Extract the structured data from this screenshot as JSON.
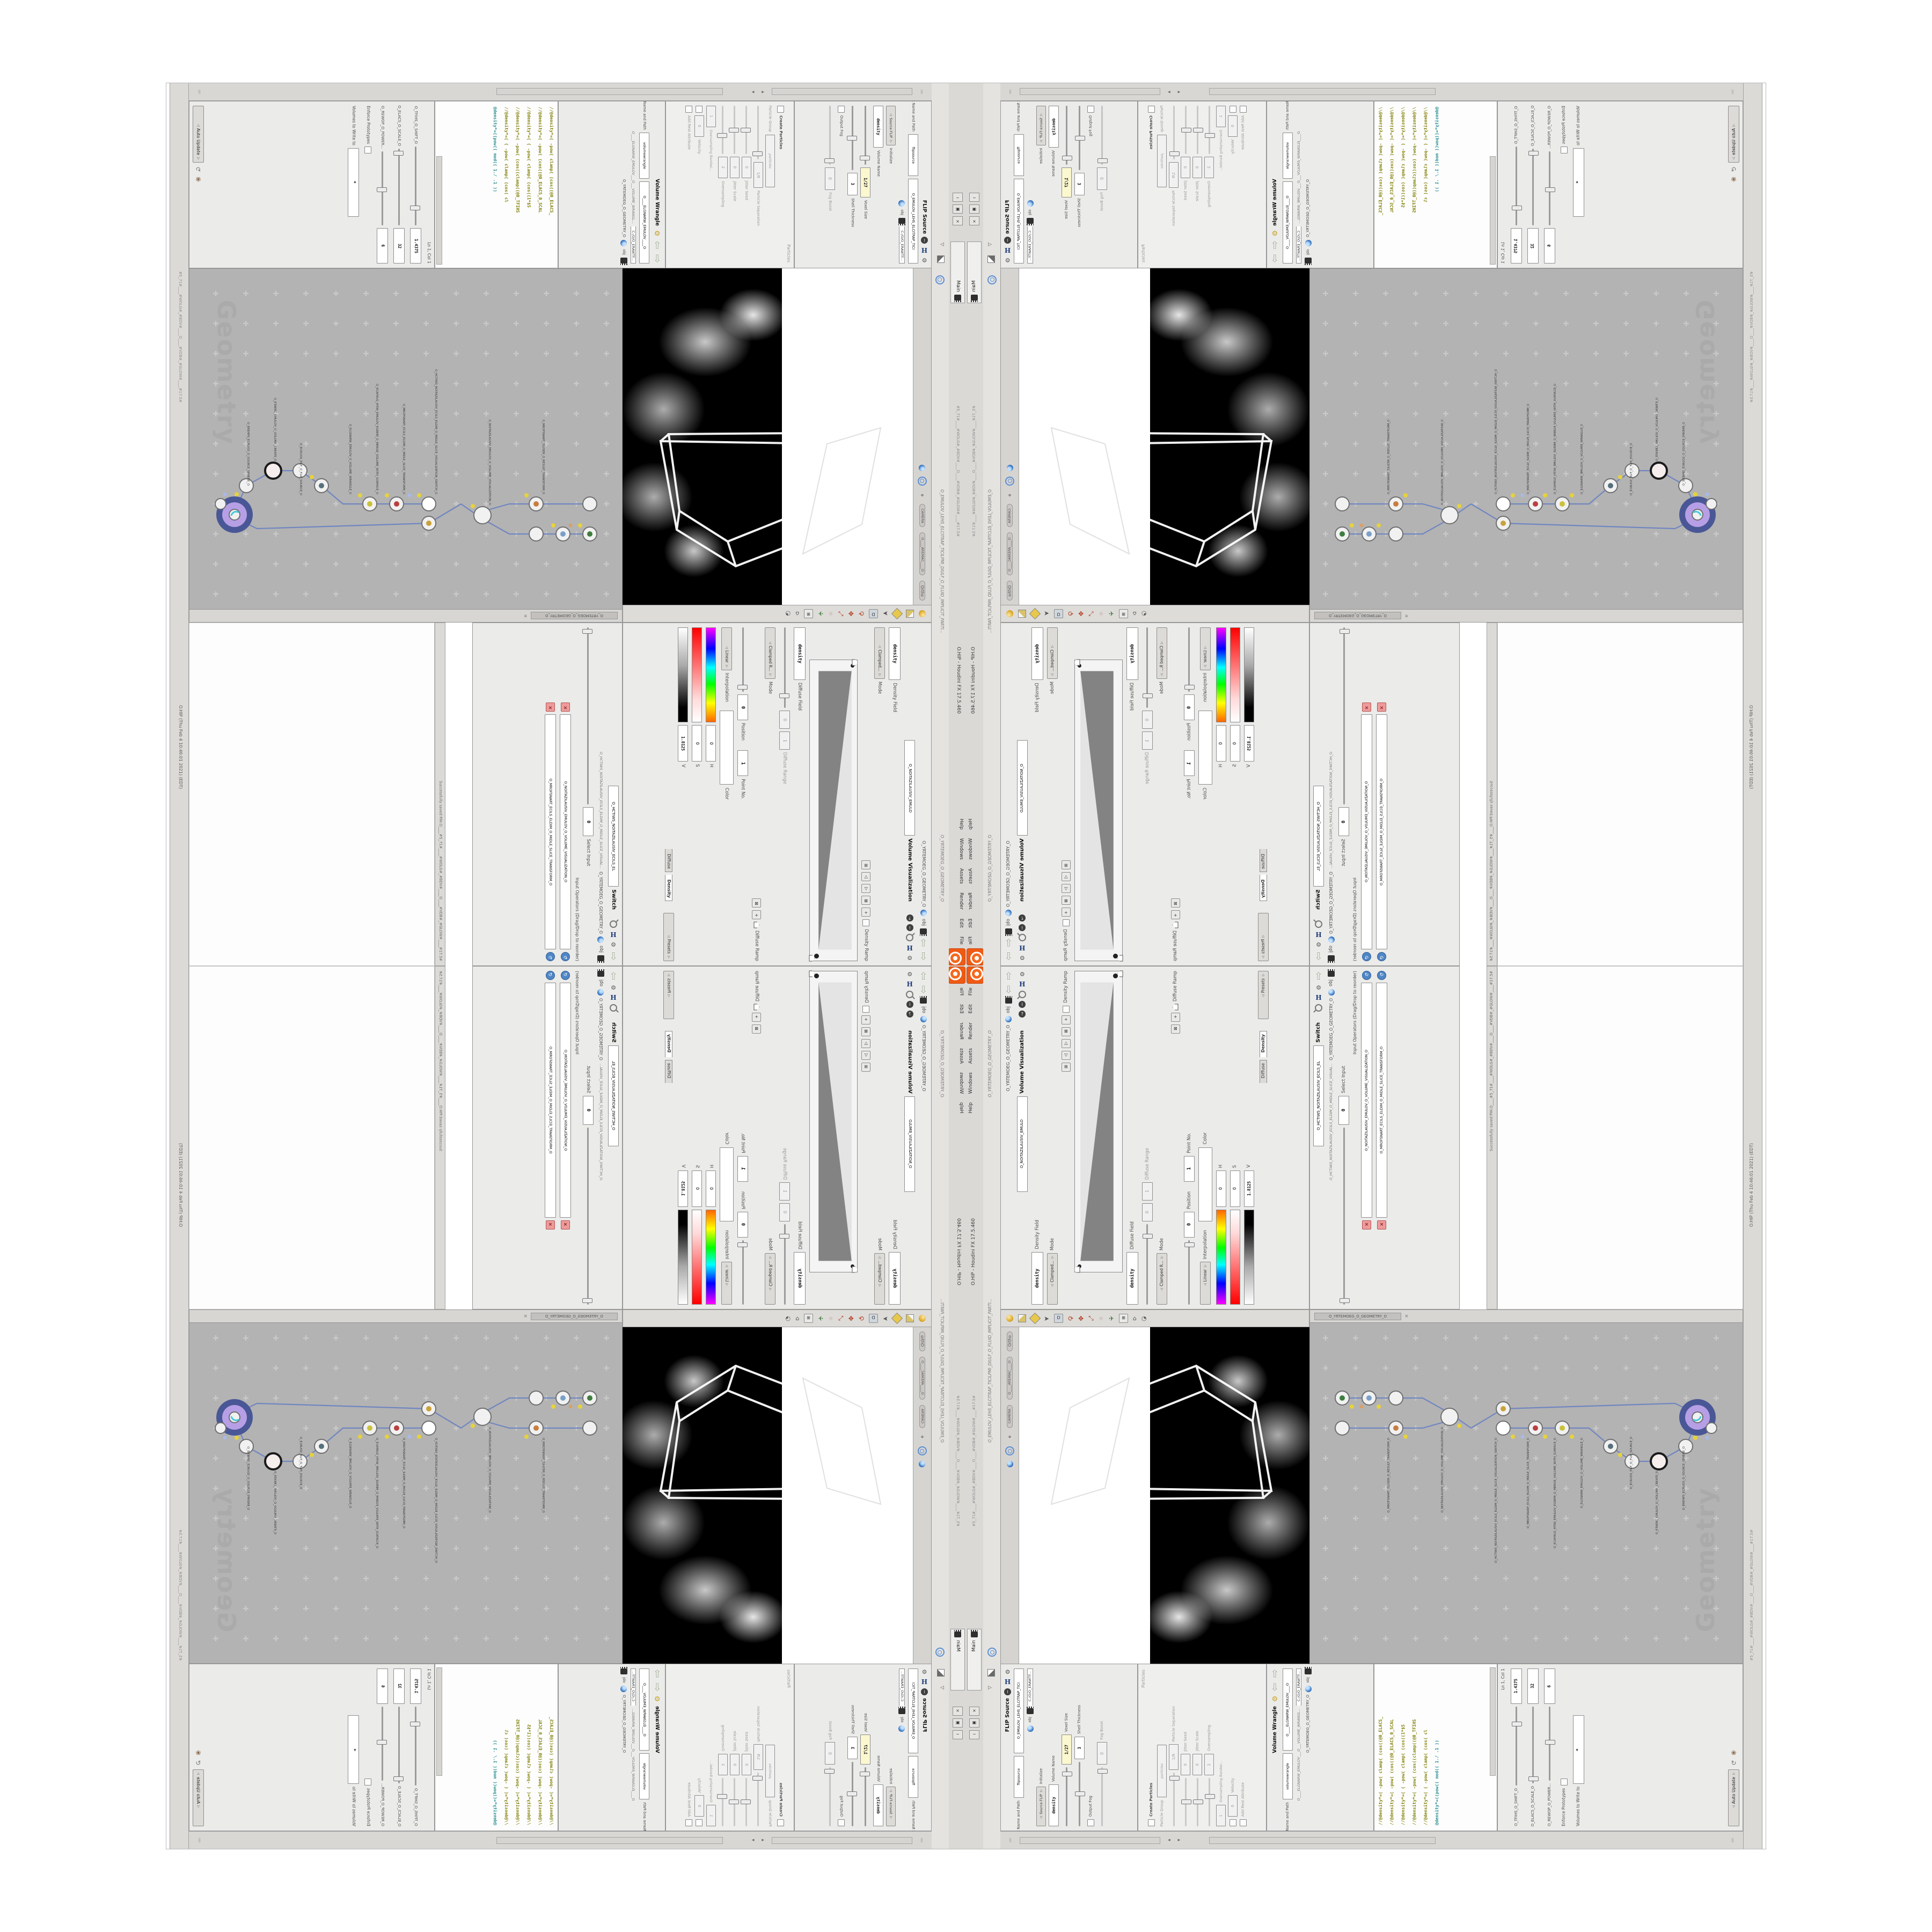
{
  "window": {
    "title": "O.HIP - Houdini FX 17.5.460",
    "meta": "#5_71#____#WOLG#_#BDV#____O____#VDB#_#GLOW#____#17.5#",
    "menu_items": [
      "File",
      "Edit",
      "Render",
      "Assets",
      "Windows",
      "Help"
    ],
    "main_tab": "Main",
    "btn_min": "─",
    "btn_restore": "▣",
    "btn_close": "×"
  },
  "status": {
    "saved": "Successfully saved PIH.O____#5_71#____#WOLG#_#BDV#____O____#VDB#_#GLOW#____#17.5#",
    "datetime": "O.HIP (Thu Feb 4 10:46:01 2021) (EDT)"
  },
  "breadcrumb": {
    "obj": "obj",
    "path": "O_YRTEMOEG_O_GEOMETRY_O"
  },
  "tabs": {
    "geometry": "O_YRTEMOEG_O_GEOMETRY_O",
    "flip_long": "O_EMULOV_LEHS_ELCITRAP_TICILPMI_DIULF_O_FLUID_IMPLICIT_PARTI...",
    "wrangle_long": "O____ELGNARW_EMULOV___O___VOLUME_WRANGL...",
    "visualization_long": "O_HCTIWS_NOITAZILAUSIV_ECILS_ELDIM_O_MIDLE_SLICE_VISUAL...",
    "camera": "O____AREMAC____O",
    "mantra": "O____ARTNAM____O",
    "file": "C:/O/O_ERAWTF..."
  },
  "volviz": {
    "title": "Volume Visualization",
    "tab": "O_NOITAZILAUSIV_EMULO",
    "density_field_label": "Density Field",
    "density_field_value": "density",
    "mode_label": "Mode",
    "mode_value": "Clamped...",
    "mode2_value": "Clamped R...",
    "density_ramp_label": "Density Ramp",
    "diffuse_field_label": "Diffuse Field",
    "diffuse_field_value": "density",
    "diffuse_range_label": "Diffuse Range",
    "range_hi": "1",
    "range_lo": "0",
    "diffuse_ramp_label": "Diffuse Ramp",
    "point_no_label": "Point No.",
    "point_no_value": "1",
    "position_label": "Position",
    "position_value": "0",
    "color_label": "Color",
    "interp_label": "Interpolation",
    "interp_value": "Linear",
    "h_label": "H",
    "h_value": "0",
    "s_label": "S",
    "s_value": "0",
    "v_label": "V",
    "v_value": "1.8125",
    "presets_label": "Presets",
    "tab_density": "Density",
    "tab_diffuse": "Diffuse"
  },
  "switch_pane": {
    "title": "Switch",
    "tab": "O_HCTIWS_NOITAZILAUSIV_ECILS_EL",
    "select_input_label": "Select Input",
    "select_input_value": "0",
    "operators_label": "Input Operators (Drag/Drop to reorder)",
    "op1": "O_NOITAZILAUSIV_EMULOV_O_VOLUME_VISUALIZATION_O",
    "op2": "O_MROFSNART_ECILS_ELDIM_O_MIDLE_SLICE_TRANSFORM_O"
  },
  "flip": {
    "title": "FLIP Source",
    "name_value": "O_EMULOV_LEHS_ELCITRAP_TICI",
    "name2_value": "flipsource",
    "asset_label": "Asset Name and Path",
    "initialize_label": "Initialize",
    "initialize_value": "Source FLIP",
    "volume_name_label": "Volume Name",
    "volume_name_value": "density",
    "voxel_size_label": "Voxel Size",
    "voxel_size_value": "1/27",
    "shell_label": "Shell Thickness",
    "shell_value": "3",
    "output_fog_label": "Output Fog",
    "fog_boost_label": "Fog Boost",
    "fog_boost_value": "0",
    "particles_group": "Particles",
    "create_particles_label": "Create Particles",
    "particles_value": "particles",
    "particle_group_label": "Particle Group",
    "particle_sep_label": "Particle Separation",
    "particle_sep_value": "1/9",
    "jitter_seed_label": "Jitter Seed",
    "jitter_seed_value": "0",
    "jitter_scale_label": "Jitter Scale",
    "jitter_scale_value": "0",
    "oversampling_label": "Oversampling",
    "oversampling_value": "2",
    "oversampling_bw_label": "Oversampling Bandwi...",
    "oversampling_bw_value": "1",
    "velocity_label": "Velocity",
    "velocity_value": "0",
    "add_rest_label": "Add Rest Attribute"
  },
  "wrangle": {
    "title": "Volume Wrangle",
    "name_value": "O____ELGNARW_EMULOV____O",
    "name2_value": "volumewrangle",
    "asset_label": "Asset Name and Path"
  },
  "code": {
    "lines": [
      "//@density*=( -pow( clamp( (cos((@0_ELACS_",
      "//@density*=( -pow( (cos((@0_ELACS_0_SCAL",
      "//@density*=( ( -pow( clamp( (cos((1*$S",
      "//@density*=( -pow( (cos((clamp((@0_TFIHS",
      "//@density*=( ( -pow( clamp( (cos( cl",
      "@density*=((pow(( mod(( 1./ .1 ))"
    ]
  },
  "params": {
    "slider1_value": "1.4375",
    "slider1_label": "O_TFIHS_O_SHIFT_O",
    "slider2_value": "32",
    "slider2_label": "O_ELACS_O_SCALE_O",
    "slider3_value": "6",
    "slider3_label": "O_REWOP_O_POWER...",
    "enforce_label": "Enforce Prototypes",
    "volumes_label": "Volumes to Write to",
    "volumes_value": "*",
    "lncol": "Ln 1, Col 1",
    "auto_update": "Auto Update"
  },
  "viewport": {
    "pill1": "Ortho",
    "pill2": "O____AREMAC____O",
    "pill3": "CAMERA"
  },
  "network": {
    "watermark": "Geometry",
    "node_labels": [
      "O_EREHPS_ECRUOS_O_SOURCE_SPHERE_O",
      "O_ETAERC_EMULOV_O_VOLUME_CREATE_O",
      "O_ECRUOS_PILF_O_FLIP_SOURCE_O",
      "O_ELGNARW_EMULOV_O_VOLUME_WRANGLE_O",
      "O_ECAFRUS_HTIW_EMULOV_EGREM_O_MERGE_VOLUME_WITH_SURFACE_O",
      "O_MROFSNART_ECILS_ELDIM_O_MIDLE_SLICE_TRANSFORM_O",
      "O_HCTIWS_NOITAZILAUSIV_ECILS_ELDIM_O_MIDLE_SLICE_VISUALIZATION_SWITCH_O",
      "O_NOITAZILAUSIV_EMULOV_O_VOLUME_VISUALIZATION_O",
      "O_MROFSNART_TLUSER_O_RESULT_TRANSFORM_O"
    ]
  },
  "icons": {
    "gear": "⚙",
    "h": "H",
    "info": "i",
    "help": "?",
    "obj_film": "",
    "up": "⇧",
    "down": "⇩",
    "left": "◂",
    "right": "▸",
    "tri_up": "△",
    "tri_dn": "▽",
    "box_plus": "⊞",
    "box_x": "⊠",
    "plus": "+",
    "x": "×",
    "reorder": "↻",
    "pin": "⌖",
    "grid_dots": "⣿"
  }
}
